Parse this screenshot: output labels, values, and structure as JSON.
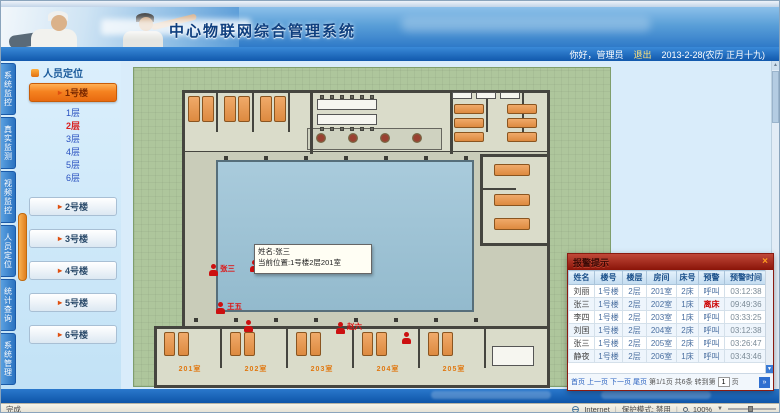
{
  "header": {
    "title": "中心物联网综合管理系统",
    "greeting": "你好，管理员",
    "logout_label": "退出",
    "date_text": "2013-2-28(农历 正月十九)"
  },
  "icons": {
    "chevron": "▸",
    "close": "×",
    "up_arrow": "▲",
    "down_arrow": "▼",
    "go_arrow": "»",
    "dropdown_arrow": "▼"
  },
  "sidebar": {
    "tabs": [
      "系统监控",
      "真实监测",
      "视频监控",
      "人员定位",
      "统计查询",
      "系统管理"
    ],
    "panel_title": "人员定位",
    "buildings": [
      "1号楼",
      "2号楼",
      "3号楼",
      "4号楼",
      "5号楼",
      "6号楼"
    ],
    "selected_building": "1号楼",
    "floors": [
      "1层",
      "2层",
      "3层",
      "4层",
      "5层",
      "6层"
    ],
    "selected_floor": "2层"
  },
  "plan": {
    "marker_labels": [
      "张三",
      "李四",
      "王五",
      "赵六"
    ],
    "room_labels": [
      "201室",
      "202室",
      "203室",
      "204室",
      "205室"
    ],
    "tooltip": {
      "line1": "姓名:张三",
      "line2": "当前位置:1号楼2层201室"
    }
  },
  "alarm_panel": {
    "title": "报警提示",
    "columns": [
      "姓名",
      "楼号",
      "楼层",
      "房间",
      "床号",
      "预警",
      "预警时间"
    ],
    "rows": [
      [
        "刘丽",
        "1号楼",
        "2层",
        "201室",
        "2床",
        "呼叫",
        "03:12:38"
      ],
      [
        "张三",
        "1号楼",
        "2层",
        "202室",
        "1床",
        "离床",
        "09:49:36"
      ],
      [
        "李四",
        "1号楼",
        "2层",
        "203室",
        "1床",
        "呼叫",
        "03:33:25"
      ],
      [
        "刘国",
        "1号楼",
        "2层",
        "204室",
        "2床",
        "呼叫",
        "03:12:38"
      ],
      [
        "张三",
        "1号楼",
        "2层",
        "205室",
        "2床",
        "呼叫",
        "03:26:47"
      ],
      [
        "静夜",
        "1号楼",
        "2层",
        "206室",
        "1床",
        "呼叫",
        "03:43:46"
      ]
    ],
    "red_warning_value": "离床",
    "pagination": {
      "first": "首页",
      "prev": "上一页",
      "next": "下一页",
      "last": "尾页",
      "info": "第1/1页 共6条",
      "goto_label": "转到第",
      "page_value": "1",
      "unit": "页"
    }
  },
  "statusbar": {
    "left_text": "完成",
    "zone_label": "Internet",
    "protect_label": "保护模式: 禁用",
    "zoom_level": "100%"
  },
  "colors": {
    "accent_orange": "#f58220",
    "alarm_red": "#8a1408",
    "marker_red": "#cc1010",
    "header_blue": "#2f7ac8"
  }
}
